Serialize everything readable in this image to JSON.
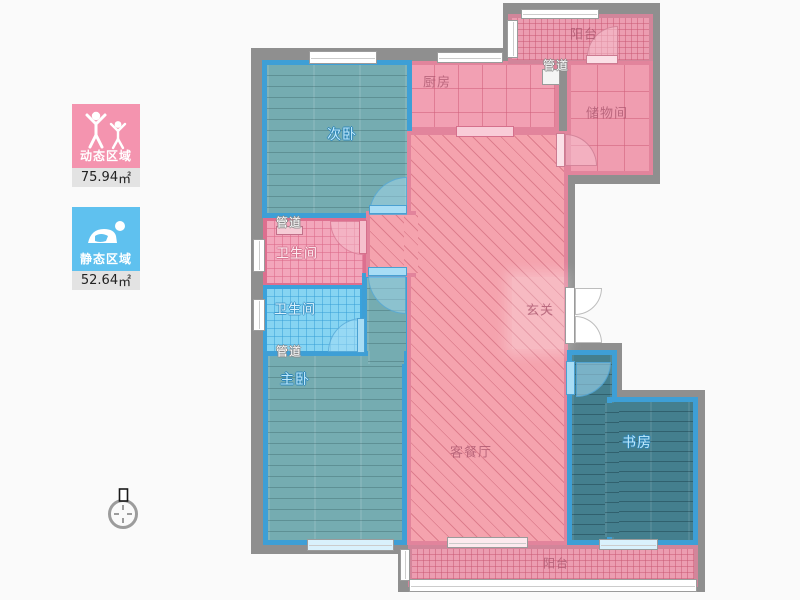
{
  "legend": {
    "items": [
      {
        "label": "动态区域",
        "value": "75.94",
        "unit": "㎡",
        "color": "#f494af",
        "icon": "active-people-icon"
      },
      {
        "label": "静态区域",
        "value": "52.64",
        "unit": "㎡",
        "color": "#5fc1ef",
        "icon": "resting-person-icon"
      }
    ]
  },
  "compass": {
    "icon": "north-compass-icon"
  },
  "floor_plan": {
    "rooms": [
      {
        "label": "次卧"
      },
      {
        "label": "厨房"
      },
      {
        "label": "阳台"
      },
      {
        "label": "管道"
      },
      {
        "label": "储物间"
      },
      {
        "label": "管道"
      },
      {
        "label": "卫生间"
      },
      {
        "label": "卫生间"
      },
      {
        "label": "管道"
      },
      {
        "label": "主卧"
      },
      {
        "label": "玄关"
      },
      {
        "label": "客餐厅"
      },
      {
        "label": "书房"
      },
      {
        "label": "阳台"
      }
    ],
    "colors": {
      "dynamic_zone": "#f494af",
      "static_zone": "#5fc1ef",
      "wall": "#8f8f8f",
      "teal_floor": "#75acb1",
      "study_floor": "#447f8e",
      "blue_lining": "#3e9fd6",
      "pink_lining": "#e2849c"
    }
  }
}
